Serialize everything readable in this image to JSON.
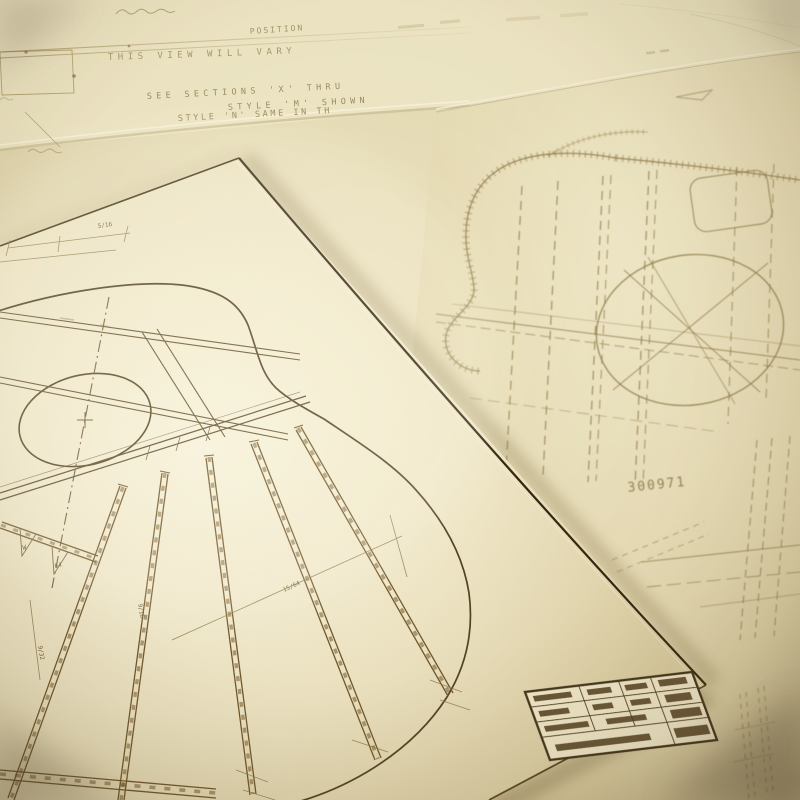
{
  "top_sheet": {
    "position_label": "POSITION",
    "view_note": "THIS VIEW WILL VARY",
    "section_note": "SEE SECTIONS 'X' THRU",
    "style_note_1": "STYLE 'M' SHOWN",
    "style_note_2": "STYLE 'N' SAME IN TH"
  },
  "right_sheet": {
    "part_number": "300971"
  },
  "left_sheet": {
    "dim_labels": [
      "5/16",
      "15/64",
      "9/16",
      "9/32",
      "W",
      "64"
    ]
  },
  "colors": {
    "paper_base": "#e2d8b2",
    "paper_bright": "#f9f4de",
    "paper_dim": "#d9cb9d",
    "ink_dark": "#2e2108",
    "ink_main": "#5d4a27",
    "ink_light": "#8f7b49",
    "ink_faint": "#ab9a6e"
  }
}
